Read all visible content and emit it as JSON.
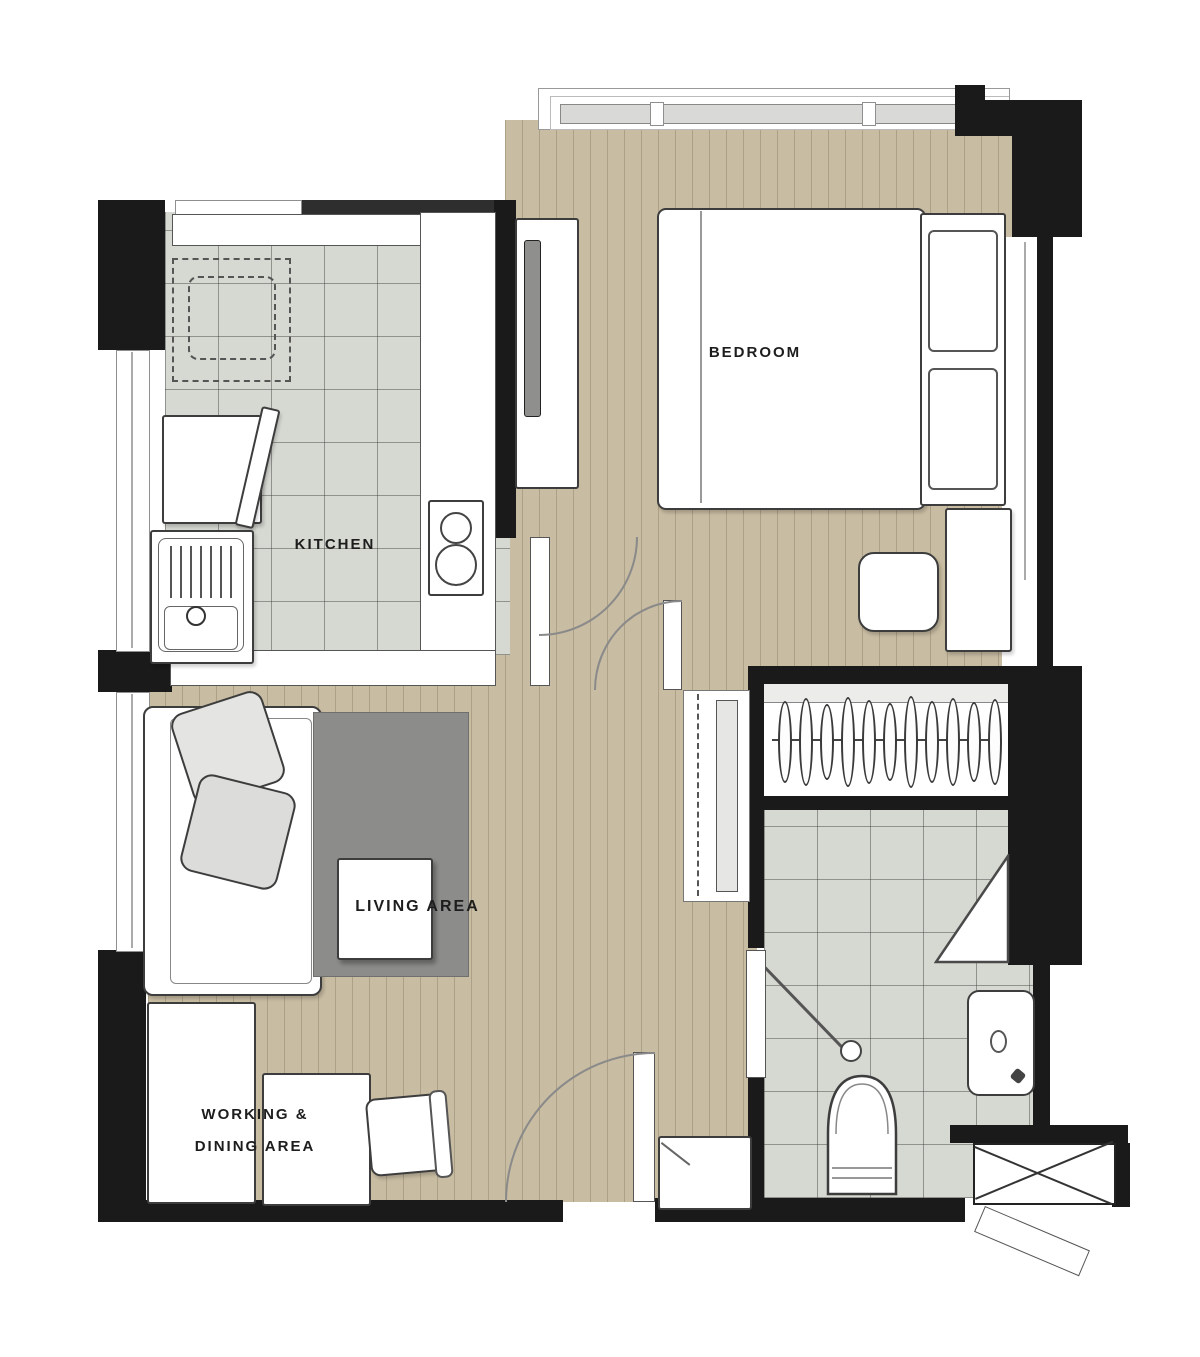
{
  "colors": {
    "wall": "#1a1a1a",
    "wood": "#c8bca2",
    "tile": "#d6d8d2",
    "rug": "#8c8c8a",
    "line": "#3d3d3d"
  },
  "rooms": {
    "bedroom": {
      "label": "BEDROOM"
    },
    "kitchen": {
      "label": "KITCHEN"
    },
    "living_area": {
      "label": "LIVING AREA"
    },
    "working_dining_area": {
      "label_line1": "WORKING &",
      "label_line2": "DINING AREA"
    }
  }
}
